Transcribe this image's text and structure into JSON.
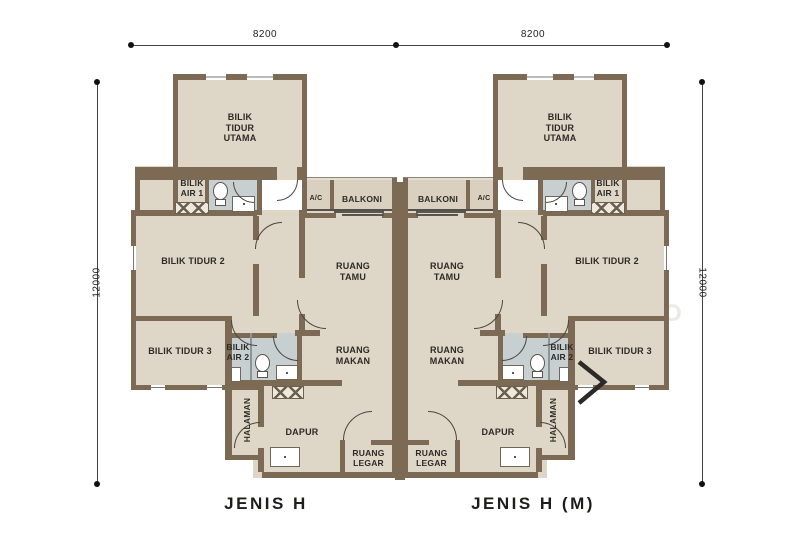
{
  "dimensions": {
    "top_left": "8200",
    "top_right": "8200",
    "side_left": "12000",
    "side_right": "12000"
  },
  "rooms": {
    "master_bedroom": "BILIK\nTIDUR\nUTAMA",
    "bathroom1": "BILIK\nAIR 1",
    "bedroom2": "BILIK TIDUR 2",
    "bedroom3": "BILIK TIDUR 3",
    "bathroom2": "BILIK\nAIR 2",
    "living_room": "RUANG\nTAMU",
    "dining_room": "RUANG\nMAKAN",
    "kitchen": "DAPUR",
    "foyer": "RUANG\nLEGAR",
    "balcony": "BALKONI",
    "ac": "A/C",
    "yard": "HALAMAN"
  },
  "captions": {
    "left_unit": "JENIS H",
    "right_unit": "JENIS H (M)"
  },
  "watermark": {
    "text": "A M B R O S E   T O O"
  },
  "colors": {
    "wall": "#7c6a54",
    "floor": "#ded6c6",
    "wet_floor": "#c7cfd1",
    "balcony_floor": "#d9d0c0",
    "text": "#2d2b27"
  }
}
